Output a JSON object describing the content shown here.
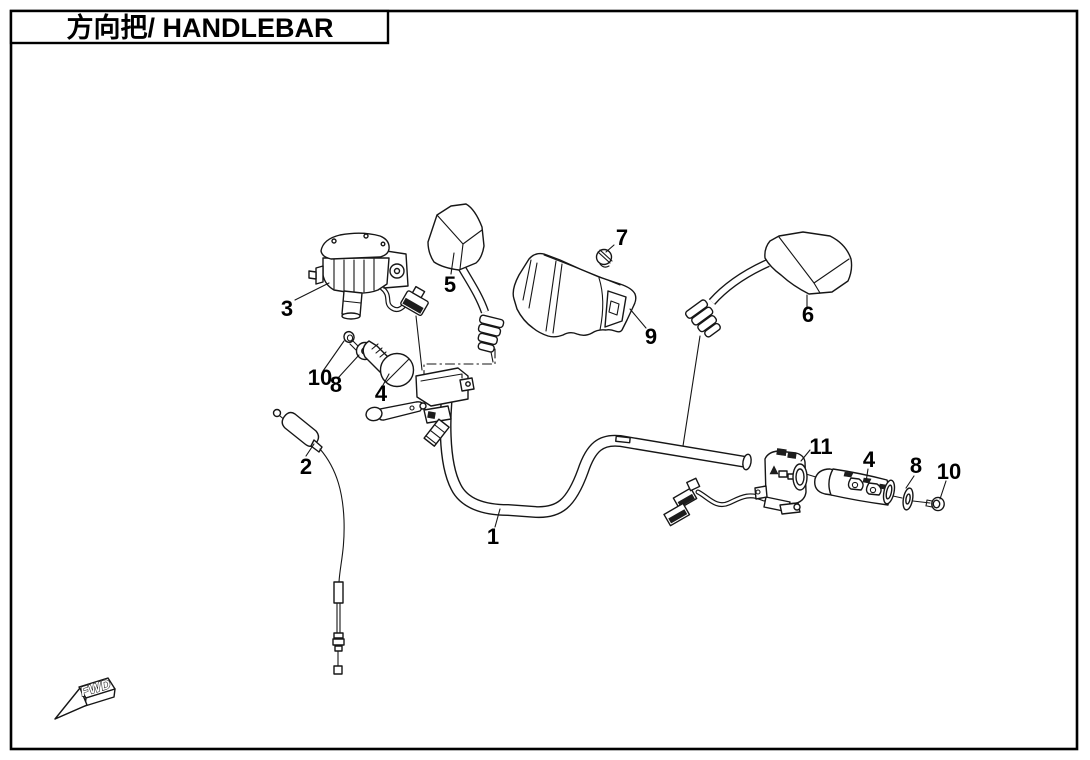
{
  "title": {
    "text": "方向把/ HANDLEBAR"
  },
  "direction_marker": {
    "label": "FWD"
  },
  "callouts": [
    {
      "label": "1",
      "points_to": "handlebar-tube"
    },
    {
      "label": "2",
      "points_to": "throttle-cable"
    },
    {
      "label": "3",
      "points_to": "throttle-housing"
    },
    {
      "label": "4",
      "points_to": "left-handle-grip"
    },
    {
      "label": "5",
      "points_to": "left-mirror"
    },
    {
      "label": "6",
      "points_to": "right-mirror"
    },
    {
      "label": "7",
      "points_to": "cover-screw"
    },
    {
      "label": "8",
      "points_to": "left-washer"
    },
    {
      "label": "9",
      "points_to": "handlebar-cover"
    },
    {
      "label": "10",
      "points_to": "left-bolt"
    },
    {
      "label": "11",
      "points_to": "switch-assembly"
    },
    {
      "label": "4",
      "points_to": "right-handle-grip"
    },
    {
      "label": "8",
      "points_to": "right-washer"
    },
    {
      "label": "10",
      "points_to": "right-bolt"
    }
  ]
}
